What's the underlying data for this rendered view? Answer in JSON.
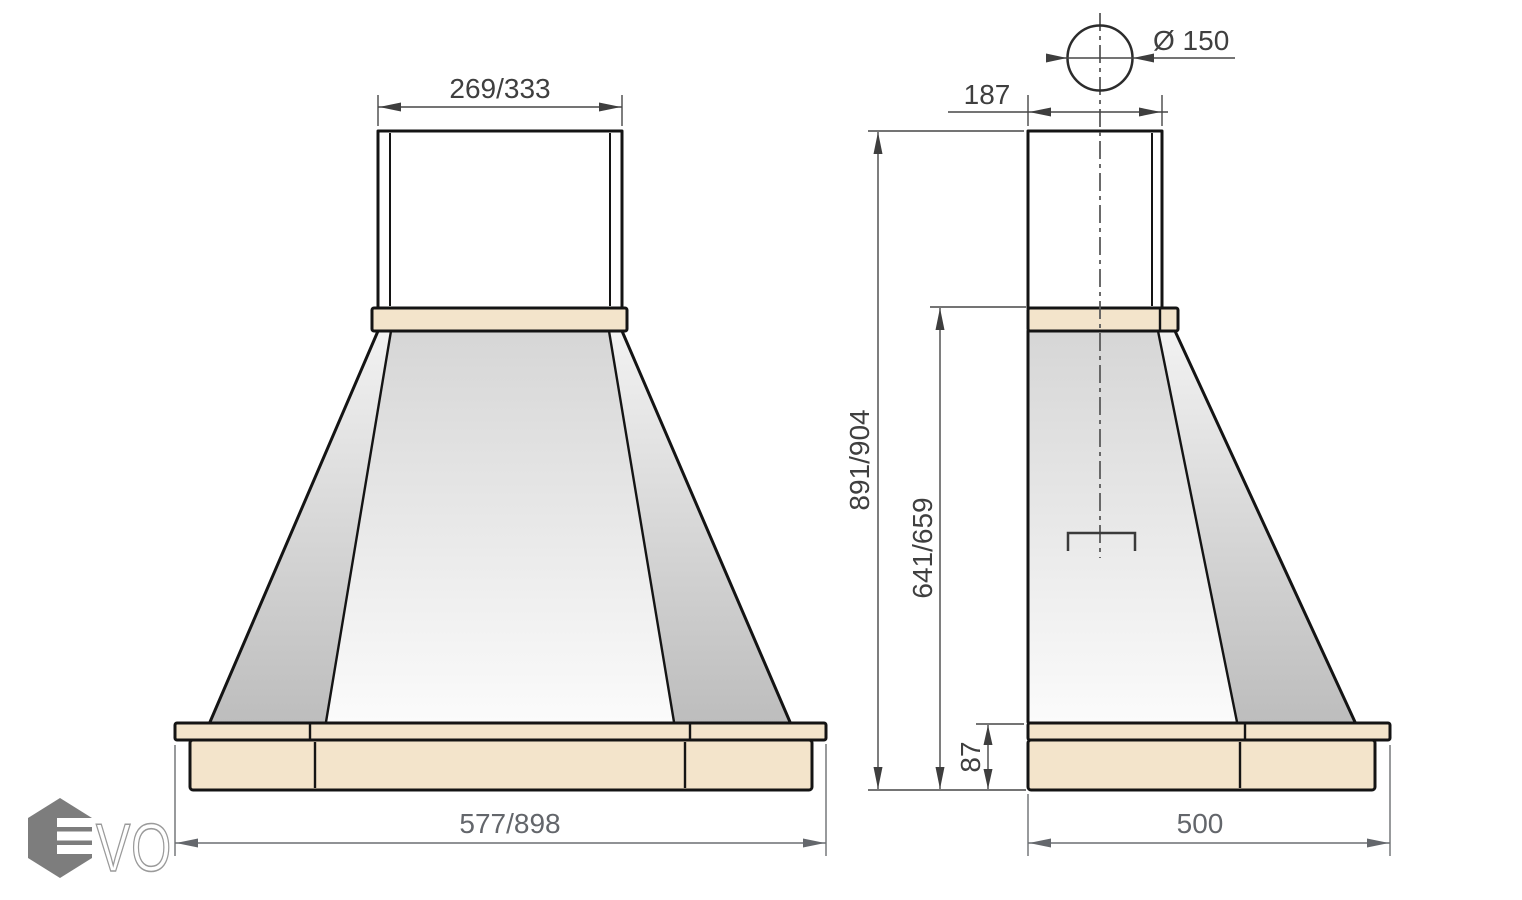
{
  "drawing": {
    "front_view": {
      "top_width": "269/333",
      "bottom_width": "577/898"
    },
    "side_view": {
      "duct_diameter": "Ø 150",
      "top_depth": "187",
      "total_height": "891/904",
      "body_height": "641/659",
      "base_height": "87",
      "bottom_depth": "500"
    },
    "logo": {
      "text": "VO"
    },
    "colors": {
      "wood": "#f3e4cb",
      "outline": "#141414",
      "dim_dark": "#3f3f3f",
      "dim_light": "#63666b",
      "logo_gray": "#7d7d7d"
    }
  }
}
